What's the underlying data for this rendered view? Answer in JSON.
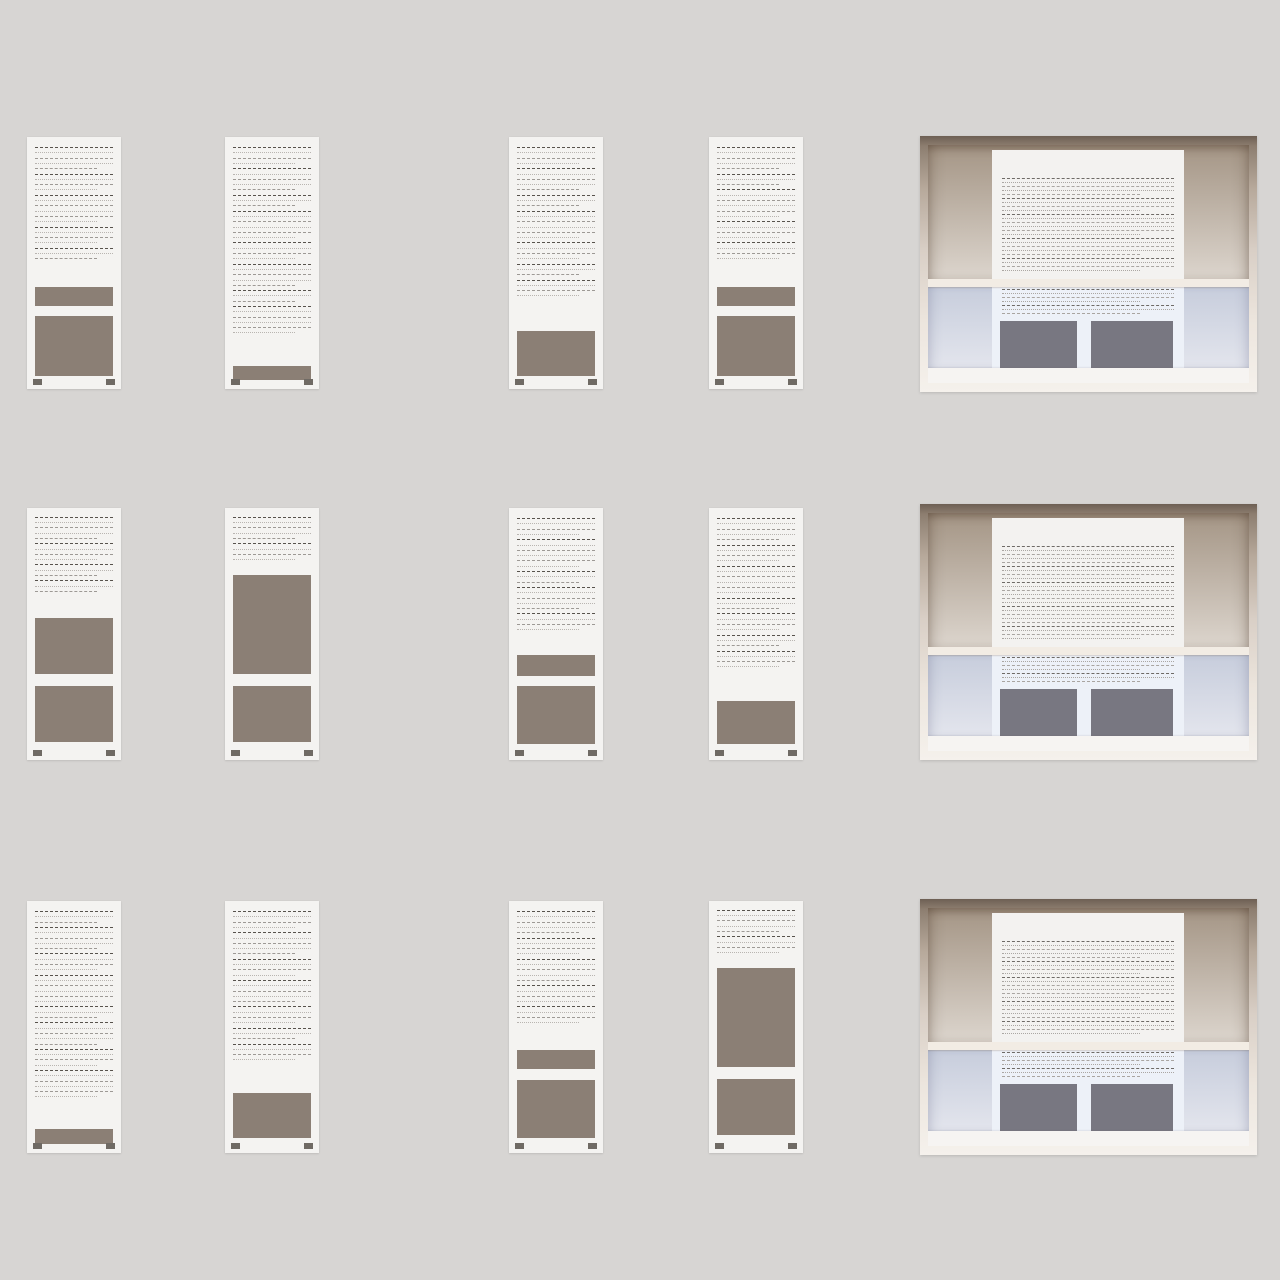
{
  "canvas": {
    "width": 1280,
    "height": 1280,
    "background": "#d7d5d3"
  },
  "palette": {
    "canvas_bg": "#d7d5d3",
    "page_bg": "#f4f3f1",
    "line_dark": "#57524c",
    "line_md": "#9d9995",
    "line_light": "#b9b5b1",
    "image_block": "#8b7f75",
    "footer_mark": "#6f6a64",
    "frame_dark": "#6e6054",
    "frame_mid": "#b6a89a",
    "frame_light": "#f5f1ec",
    "top_grad_a": "#a49585",
    "top_grad_b": "#dcd5cd",
    "divider": "#f2ece4",
    "bottom_grad_a": "#c7cddc",
    "bottom_grad_b": "#e3e5ed",
    "panel_footer": "#f6f4f2",
    "panel_page": "#f3f2f0",
    "panel_lower": "#edf1f8",
    "panel_block": "#787781",
    "panel_line_dark": "#6e6a66",
    "panel_line_light": "#aba7a3"
  },
  "grid": {
    "column_x": [
      27,
      225,
      509,
      709
    ],
    "row_y": [
      137,
      508,
      901
    ],
    "page_w": 94,
    "page_h": 252,
    "panel_x": 920,
    "panel_y": [
      136,
      504,
      899
    ],
    "panel_w": 337,
    "panel_h": 256
  },
  "page_thumbnails": [
    {
      "row": 0,
      "col": 0,
      "label": "text, small image, large image",
      "segments": [
        {
          "type": "text",
          "top": 4,
          "height": 53.5,
          "paras": [
            5,
            4,
            6,
            4,
            3
          ]
        },
        {
          "type": "image",
          "top": 59.5,
          "height": 7.5
        },
        {
          "type": "image",
          "top": 71,
          "height": 24
        }
      ]
    },
    {
      "row": 0,
      "col": 1,
      "label": "full text, bottom strip",
      "segments": [
        {
          "type": "text",
          "top": 4,
          "height": 86,
          "paras": [
            4,
            5,
            3,
            6,
            4,
            5,
            3,
            6
          ]
        },
        {
          "type": "image",
          "top": 91,
          "height": 5.5
        }
      ]
    },
    {
      "row": 0,
      "col": 2,
      "label": "text, bottom image",
      "segments": [
        {
          "type": "text",
          "top": 4,
          "height": 71,
          "paras": [
            4,
            5,
            3,
            6,
            4,
            3,
            4
          ]
        },
        {
          "type": "image",
          "top": 77,
          "height": 18
        }
      ]
    },
    {
      "row": 0,
      "col": 3,
      "label": "text, small image, large image",
      "segments": [
        {
          "type": "text",
          "top": 4,
          "height": 53.5,
          "paras": [
            5,
            3,
            6,
            4,
            4
          ]
        },
        {
          "type": "image",
          "top": 59.5,
          "height": 7.5
        },
        {
          "type": "image",
          "top": 71,
          "height": 24
        }
      ]
    },
    {
      "row": 1,
      "col": 0,
      "label": "text, two images",
      "segments": [
        {
          "type": "text",
          "top": 3.5,
          "height": 38,
          "paras": [
            5,
            4,
            3,
            3
          ]
        },
        {
          "type": "image",
          "top": 43.5,
          "height": 22.5
        },
        {
          "type": "image",
          "top": 70.5,
          "height": 22.5
        }
      ]
    },
    {
      "row": 1,
      "col": 1,
      "label": "short text, tall image, image",
      "segments": [
        {
          "type": "text",
          "top": 3.5,
          "height": 21,
          "paras": [
            5,
            4
          ]
        },
        {
          "type": "image",
          "top": 26.5,
          "height": 39.5
        },
        {
          "type": "image",
          "top": 70.5,
          "height": 22.5
        }
      ]
    },
    {
      "row": 1,
      "col": 2,
      "label": "text, small image, large image",
      "segments": [
        {
          "type": "text",
          "top": 4,
          "height": 53,
          "paras": [
            4,
            6,
            3,
            5,
            4
          ]
        },
        {
          "type": "image",
          "top": 58.5,
          "height": 8
        },
        {
          "type": "image",
          "top": 70.5,
          "height": 23
        }
      ]
    },
    {
      "row": 1,
      "col": 3,
      "label": "text, bottom image",
      "segments": [
        {
          "type": "text",
          "top": 4,
          "height": 71.5,
          "paras": [
            5,
            4,
            6,
            3,
            4,
            3,
            4
          ]
        },
        {
          "type": "image",
          "top": 76.5,
          "height": 17
        }
      ]
    },
    {
      "row": 2,
      "col": 0,
      "label": "full text, bottom strip",
      "segments": [
        {
          "type": "text",
          "top": 4,
          "height": 85.5,
          "paras": [
            3,
            5,
            4,
            6,
            3,
            5,
            4,
            6
          ]
        },
        {
          "type": "image",
          "top": 90.5,
          "height": 6
        }
      ]
    },
    {
      "row": 2,
      "col": 1,
      "label": "text, bottom image",
      "segments": [
        {
          "type": "text",
          "top": 4,
          "height": 71,
          "paras": [
            4,
            5,
            4,
            5,
            4,
            3,
            4
          ]
        },
        {
          "type": "image",
          "top": 76,
          "height": 18
        }
      ]
    },
    {
      "row": 2,
      "col": 2,
      "label": "text, small image, large image",
      "segments": [
        {
          "type": "text",
          "top": 4,
          "height": 53.5,
          "paras": [
            5,
            4,
            5,
            4,
            4
          ]
        },
        {
          "type": "image",
          "top": 59,
          "height": 7.5
        },
        {
          "type": "image",
          "top": 71,
          "height": 23
        }
      ]
    },
    {
      "row": 2,
      "col": 3,
      "label": "short text, tall image, image",
      "segments": [
        {
          "type": "text",
          "top": 3.5,
          "height": 21.5,
          "paras": [
            5,
            4
          ]
        },
        {
          "type": "image",
          "top": 26.5,
          "height": 39.5
        },
        {
          "type": "image",
          "top": 70.5,
          "height": 22.5
        }
      ]
    }
  ],
  "panel_thumbnails": [
    {
      "row": 0,
      "label": "wide spread with hero, page and two images"
    },
    {
      "row": 1,
      "label": "wide spread with hero, page and two images"
    },
    {
      "row": 2,
      "label": "wide spread with hero, page and two images"
    }
  ],
  "panel_template": {
    "top_section": {
      "top": 0,
      "height": 56.5
    },
    "divider": {
      "top": 56.5,
      "height": 3
    },
    "bottom_section": {
      "top": 59.5,
      "height": 34.2
    },
    "footer": {
      "top": 93.7,
      "height": 6.3
    },
    "page": {
      "left": 20,
      "top": 2.1,
      "width": 59.8,
      "height": 54.4,
      "blank_top": 28,
      "paras": [
        5,
        4,
        6,
        5,
        4
      ]
    },
    "lower_page": {
      "left": 20,
      "top": 59.5,
      "width": 59.8,
      "height": 34.2,
      "paras": [
        4,
        3
      ]
    },
    "blocks": [
      {
        "left": 22.4,
        "top": 74,
        "width": 24,
        "height": 19.7
      },
      {
        "left": 50.8,
        "top": 74,
        "width": 25.5,
        "height": 19.7
      }
    ]
  }
}
